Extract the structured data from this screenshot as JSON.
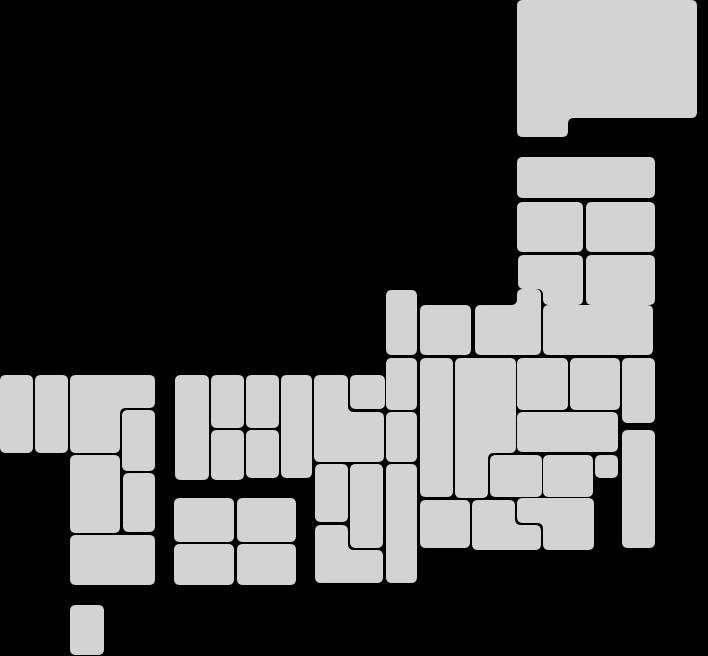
{
  "canvas": {
    "width": 708,
    "height": 656,
    "background_color": "#000000"
  },
  "map": {
    "kind": "japan-prefecture-tile-grid",
    "tile_fill_color": "#d3d3d3",
    "corner_radius": 6,
    "tiles": [
      {
        "id": "hokkaido",
        "points": [
          [
            517,
            0
          ],
          [
            697,
            0
          ],
          [
            697,
            118
          ],
          [
            568,
            118
          ],
          [
            568,
            137
          ],
          [
            517,
            137
          ]
        ]
      },
      {
        "id": "tohoku-1",
        "rect": [
          517,
          157,
          138,
          41
        ]
      },
      {
        "id": "tohoku-2",
        "rect": [
          517,
          202,
          66,
          50
        ]
      },
      {
        "id": "tohoku-3",
        "rect": [
          586,
          202,
          69,
          50
        ]
      },
      {
        "id": "tohoku-4",
        "points": [
          [
            518,
            255
          ],
          [
            583,
            255
          ],
          [
            583,
            305
          ],
          [
            543,
            305
          ],
          [
            543,
            289
          ],
          [
            518,
            289
          ]
        ]
      },
      {
        "id": "tohoku-5",
        "rect": [
          586,
          255,
          69,
          50
        ]
      },
      {
        "id": "tohoku-6",
        "points": [
          [
            475,
            305
          ],
          [
            517,
            305
          ],
          [
            517,
            289
          ],
          [
            541,
            289
          ],
          [
            541,
            355
          ],
          [
            475,
            355
          ]
        ]
      },
      {
        "id": "tohoku-7",
        "rect": [
          543,
          305,
          110,
          50
        ]
      },
      {
        "id": "chubu-1",
        "rect": [
          386,
          290,
          31,
          65
        ]
      },
      {
        "id": "chubu-2",
        "rect": [
          420,
          305,
          51,
          50
        ]
      },
      {
        "id": "chubu-3",
        "rect": [
          386,
          358,
          31,
          52
        ]
      },
      {
        "id": "chubu-4",
        "rect": [
          420,
          358,
          33,
          139
        ]
      },
      {
        "id": "chubu-5",
        "points": [
          [
            455,
            358
          ],
          [
            516,
            358
          ],
          [
            516,
            453
          ],
          [
            488,
            453
          ],
          [
            488,
            498
          ],
          [
            455,
            498
          ]
        ]
      },
      {
        "id": "chubu-6",
        "rect": [
          517,
          358,
          51,
          52
        ]
      },
      {
        "id": "chubu-7",
        "rect": [
          570,
          358,
          50,
          52
        ]
      },
      {
        "id": "chubu-8",
        "rect": [
          386,
          412,
          31,
          50
        ]
      },
      {
        "id": "kanto-1",
        "rect": [
          622,
          358,
          33,
          65
        ]
      },
      {
        "id": "kanto-2",
        "rect": [
          517,
          412,
          101,
          40
        ]
      },
      {
        "id": "kanto-3",
        "rect": [
          622,
          430,
          33,
          118
        ]
      },
      {
        "id": "kanto-4",
        "rect": [
          490,
          455,
          52,
          42
        ]
      },
      {
        "id": "kanto-5",
        "rect": [
          543,
          455,
          50,
          42
        ]
      },
      {
        "id": "kanto-6",
        "rect": [
          595,
          455,
          23,
          23
        ]
      },
      {
        "id": "kanto-7",
        "rect": [
          420,
          500,
          50,
          48
        ]
      },
      {
        "id": "kanto-8",
        "points": [
          [
            472,
            500
          ],
          [
            515,
            500
          ],
          [
            515,
            525
          ],
          [
            541,
            525
          ],
          [
            541,
            550
          ],
          [
            472,
            550
          ]
        ]
      },
      {
        "id": "kanto-9",
        "points": [
          [
            517,
            498
          ],
          [
            594,
            498
          ],
          [
            594,
            550
          ],
          [
            543,
            550
          ],
          [
            543,
            523
          ],
          [
            517,
            523
          ]
        ]
      },
      {
        "id": "kinki-1",
        "rect": [
          350,
          375,
          35,
          34
        ]
      },
      {
        "id": "kinki-2",
        "points": [
          [
            314,
            375
          ],
          [
            348,
            375
          ],
          [
            348,
            412
          ],
          [
            384,
            412
          ],
          [
            384,
            462
          ],
          [
            314,
            462
          ]
        ]
      },
      {
        "id": "kinki-3",
        "rect": [
          315,
          464,
          33,
          58
        ]
      },
      {
        "id": "kinki-4",
        "rect": [
          350,
          464,
          33,
          84
        ]
      },
      {
        "id": "kinki-5",
        "points": [
          [
            315,
            525
          ],
          [
            348,
            525
          ],
          [
            348,
            550
          ],
          [
            383,
            550
          ],
          [
            383,
            583
          ],
          [
            315,
            583
          ]
        ]
      },
      {
        "id": "kinki-6",
        "rect": [
          386,
          464,
          31,
          119
        ]
      },
      {
        "id": "chugoku-1",
        "rect": [
          175,
          375,
          34,
          105
        ]
      },
      {
        "id": "chugoku-2",
        "rect": [
          211,
          375,
          33,
          53
        ]
      },
      {
        "id": "chugoku-3",
        "rect": [
          211,
          430,
          33,
          50
        ]
      },
      {
        "id": "chugoku-4",
        "rect": [
          246,
          375,
          33,
          53
        ]
      },
      {
        "id": "chugoku-5",
        "rect": [
          246,
          430,
          33,
          48
        ]
      },
      {
        "id": "chugoku-6",
        "rect": [
          281,
          375,
          31,
          103
        ]
      },
      {
        "id": "shikoku-1",
        "rect": [
          174,
          498,
          60,
          44
        ]
      },
      {
        "id": "shikoku-2",
        "rect": [
          237,
          498,
          59,
          44
        ]
      },
      {
        "id": "shikoku-3",
        "rect": [
          174,
          544,
          60,
          41
        ]
      },
      {
        "id": "shikoku-4",
        "rect": [
          237,
          544,
          59,
          41
        ]
      },
      {
        "id": "kyushu-1",
        "rect": [
          0,
          375,
          33,
          78
        ]
      },
      {
        "id": "kyushu-2",
        "rect": [
          35,
          375,
          33,
          78
        ]
      },
      {
        "id": "kyushu-3",
        "points": [
          [
            70,
            375
          ],
          [
            155,
            375
          ],
          [
            155,
            408
          ],
          [
            120,
            408
          ],
          [
            120,
            453
          ],
          [
            70,
            453
          ]
        ]
      },
      {
        "id": "kyushu-4",
        "rect": [
          122,
          410,
          33,
          61
        ]
      },
      {
        "id": "kyushu-5",
        "rect": [
          70,
          455,
          50,
          78
        ]
      },
      {
        "id": "kyushu-6",
        "rect": [
          123,
          473,
          32,
          59
        ]
      },
      {
        "id": "kyushu-7",
        "rect": [
          70,
          535,
          85,
          50
        ]
      },
      {
        "id": "okinawa",
        "rect": [
          70,
          605,
          34,
          50
        ]
      }
    ]
  }
}
